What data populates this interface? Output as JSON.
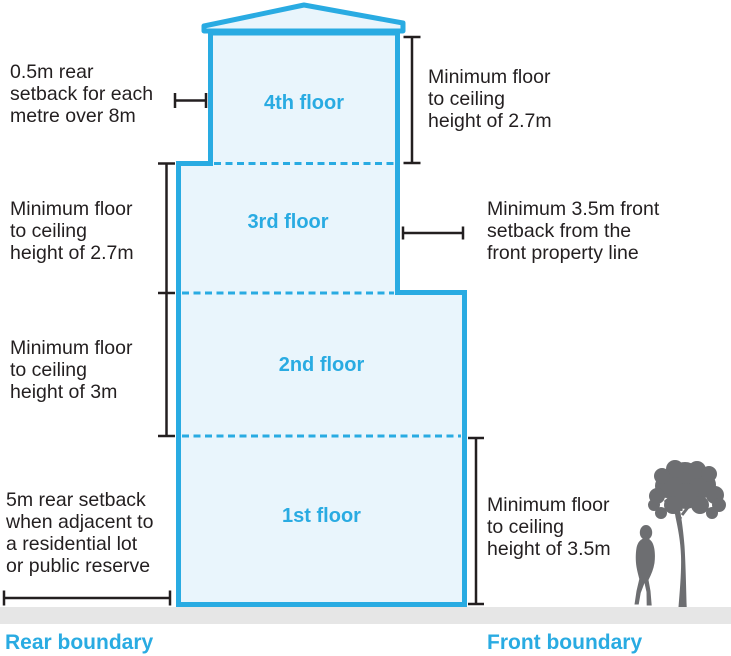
{
  "colors": {
    "accent_blue": "#29ABE2",
    "building_fill": "#E9F5FC",
    "text_dark": "#231F20",
    "ground_gray": "#E6E6E6",
    "silhouette_gray": "#6D6E71"
  },
  "floors": [
    {
      "label": "4th floor"
    },
    {
      "label": "3rd floor"
    },
    {
      "label": "2nd floor"
    },
    {
      "label": "1st floor"
    }
  ],
  "annotations": {
    "rear_setback_upper": {
      "lines": [
        "0.5m rear",
        "setback for each",
        "metre over 8m"
      ]
    },
    "ceiling_height_4th": {
      "lines": [
        "Minimum floor",
        "to ceiling",
        "height of 2.7m"
      ]
    },
    "ceiling_height_3rd": {
      "lines": [
        "Minimum floor",
        "to ceiling",
        "height of 2.7m"
      ]
    },
    "front_setback": {
      "lines": [
        "Minimum 3.5m front",
        "setback from the",
        "front property line"
      ]
    },
    "ceiling_height_2nd": {
      "lines": [
        "Minimum floor",
        "to ceiling",
        "height of 3m"
      ]
    },
    "rear_setback_lower": {
      "lines": [
        "5m rear setback",
        "when adjacent to",
        "a residential lot",
        "or public reserve"
      ]
    },
    "ceiling_height_1st": {
      "lines": [
        "Minimum floor",
        "to ceiling",
        "height of 3.5m"
      ]
    }
  },
  "boundaries": {
    "rear": "Rear boundary",
    "front": "Front boundary"
  },
  "icons": {
    "person": "person-silhouette",
    "tree": "tree-silhouette"
  }
}
